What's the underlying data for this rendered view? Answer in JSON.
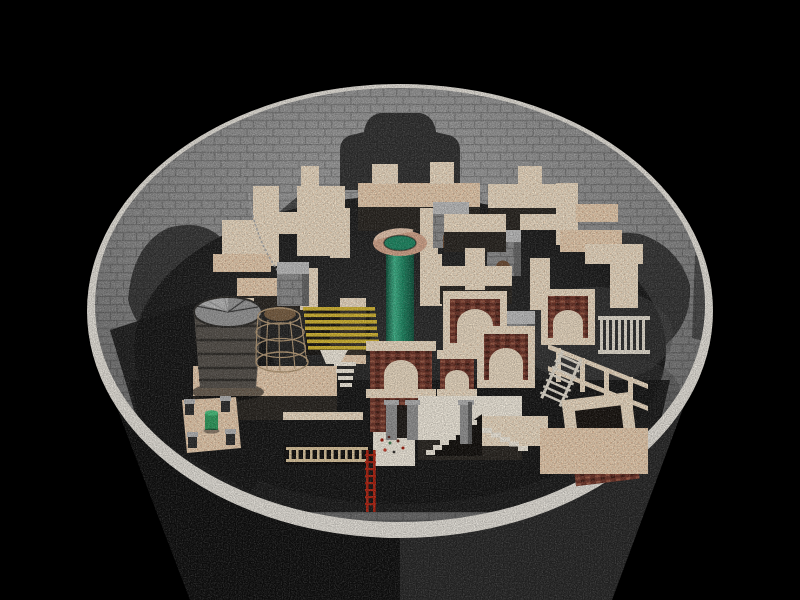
{
  "scene": {
    "type": "3d-render",
    "setting": "circular brick well viewed from above containing a cream stone maze",
    "objects": [
      {
        "id": "well-rim",
        "color_ref": "rim"
      },
      {
        "id": "well-interior-wall",
        "color_ref": "wall_light"
      },
      {
        "id": "well-exterior",
        "color_ref": "exterior_right"
      },
      {
        "id": "maze-walls",
        "color_ref": "maze_top"
      },
      {
        "id": "green-column",
        "color_ref": "column_green"
      },
      {
        "id": "column-ring",
        "color_ref": "ring_outer"
      },
      {
        "id": "wooden-barrel",
        "color_ref": "barrel_body"
      },
      {
        "id": "wire-cage",
        "color_ref": "cage_wire"
      },
      {
        "id": "yellow-slat-rack",
        "color_ref": "slat_yellow"
      },
      {
        "id": "stone-cube-towers",
        "color_ref": "cube_face"
      },
      {
        "id": "brick-archways",
        "color_ref": "arch_brick"
      },
      {
        "id": "frame-tower",
        "color_ref": "arch_brick"
      },
      {
        "id": "bridge-walkway",
        "color_ref": "maze_top"
      },
      {
        "id": "portcullis-bars",
        "color_ref": "white_bar"
      },
      {
        "id": "gate-pillars",
        "color_ref": "post_grey"
      },
      {
        "id": "stone-obelisk",
        "color_ref": "post_grey"
      },
      {
        "id": "white-staircase",
        "color_ref": "step_white"
      },
      {
        "id": "wooden-ladder",
        "color_ref": "ladder_wood"
      },
      {
        "id": "red-ladder",
        "color_ref": "ladder_red"
      },
      {
        "id": "corner-post-platform",
        "color_ref": "maze_warm"
      },
      {
        "id": "mini-green-cylinder",
        "color_ref": "mini_green"
      },
      {
        "id": "hanging-chain",
        "color_ref": "chain_grey"
      },
      {
        "id": "debris-specks",
        "color_ref": "ladder_red"
      }
    ]
  },
  "colors": {
    "background": "#000000",
    "rim": "#ebe7df",
    "wall_light": "#a6a6a6",
    "wall_mid": "#8e8e8e",
    "wall_deep": "#6f6f6f",
    "wall_edge": "#525252",
    "wall_shadow": "#232323",
    "floor_shadow": "#141414",
    "floor_mid": "#2c2c2c",
    "exterior_left": "#0e0e0e",
    "exterior_right": "#272727",
    "maze_top": "#f3e2c9",
    "maze_warm": "#eed3b4",
    "maze_side": "#28241f",
    "column_green": "#1d8a64",
    "column_green_dark": "#0e523c",
    "column_green_light": "#3fb88c",
    "ring_outer": "#d8a88d",
    "ring_light": "#eccbb2",
    "cube_top": "#c2c2c2",
    "cube_face": "#8f8f8f",
    "cube_dark": "#5e5e5e",
    "arch_brick": "#6f3327",
    "arch_brick_dark": "#421b12",
    "arch_spot": "#9c5741",
    "arch_inner": "#f0dfc6",
    "arch_hole": "#1c1410",
    "door_brown": "#6f4c32",
    "barrel_top": "#9a9a9a",
    "barrel_body": "#55504a",
    "barrel_band": "#2f2c28",
    "cage_wire": "#b79b77",
    "slat_yellow": "#d9ba31",
    "ladder_wood": "#e0c9a0",
    "ladder_red": "#b3220f",
    "mini_green": "#2e9e5e",
    "post_grey": "#949494",
    "step_white": "#f7f0e2",
    "white_bar": "#e9e2d4",
    "chain_grey": "#b0b0b0"
  }
}
